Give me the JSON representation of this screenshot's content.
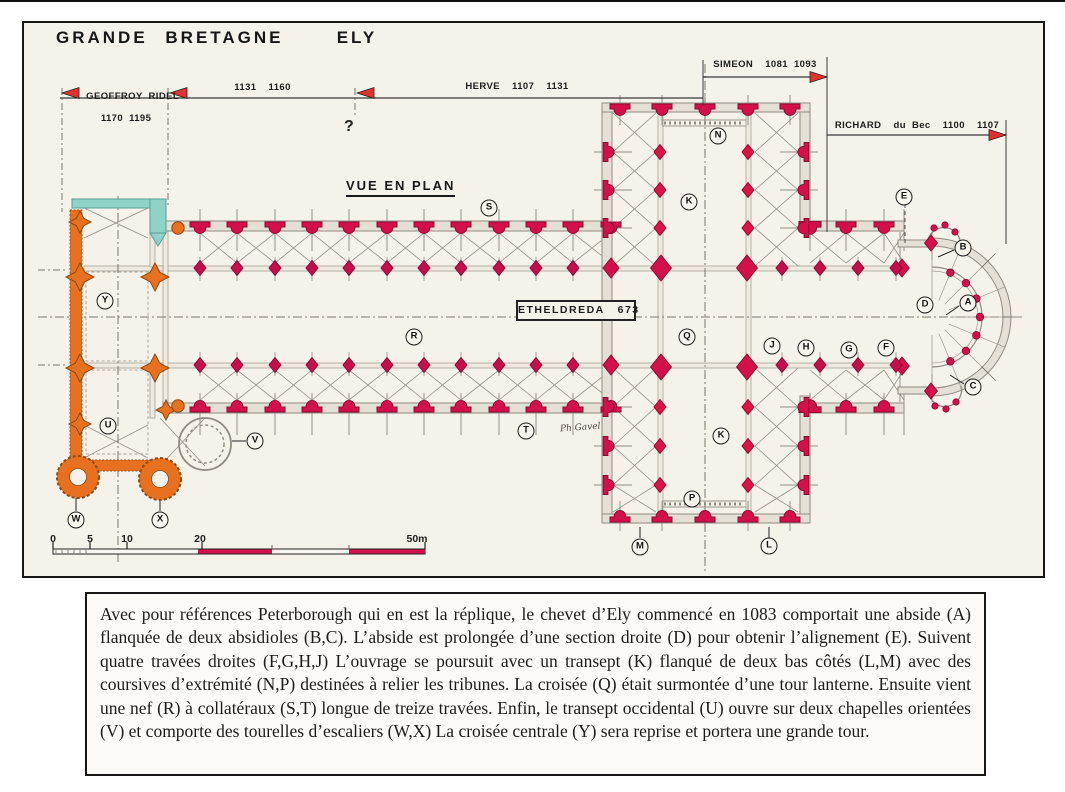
{
  "title": "GRANDE BRETAGNE   ELY",
  "timeline": {
    "segments": [
      {
        "label": "GEOFFROY RIDEL",
        "sublabel": "1170 1195"
      },
      {
        "label": "1131  1160"
      },
      {
        "label": "HERVE  1107  1131"
      },
      {
        "label": "SIMEON  1081 1093"
      },
      {
        "label": "RICHARD  du Bec  1100  1107"
      }
    ],
    "question_mark": "?"
  },
  "plan": {
    "view_label": "VUE EN PLAN",
    "founder_label": "ETHELDREDA   673",
    "signature": "Ph Gavel",
    "markers": [
      {
        "letter": "A",
        "x": 968,
        "y": 303
      },
      {
        "letter": "B",
        "x": 963,
        "y": 248
      },
      {
        "letter": "C",
        "x": 973,
        "y": 387
      },
      {
        "letter": "D",
        "x": 925,
        "y": 305
      },
      {
        "letter": "E",
        "x": 904,
        "y": 197
      },
      {
        "letter": "F",
        "x": 886,
        "y": 348
      },
      {
        "letter": "G",
        "x": 849,
        "y": 350
      },
      {
        "letter": "H",
        "x": 806,
        "y": 348
      },
      {
        "letter": "J",
        "x": 772,
        "y": 346
      },
      {
        "letter": "K",
        "x": 689,
        "y": 202
      },
      {
        "letter": "K",
        "x": 721,
        "y": 436
      },
      {
        "letter": "L",
        "x": 769,
        "y": 546
      },
      {
        "letter": "M",
        "x": 640,
        "y": 547
      },
      {
        "letter": "N",
        "x": 718,
        "y": 136
      },
      {
        "letter": "P",
        "x": 692,
        "y": 499
      },
      {
        "letter": "Q",
        "x": 687,
        "y": 337
      },
      {
        "letter": "R",
        "x": 414,
        "y": 337
      },
      {
        "letter": "S",
        "x": 489,
        "y": 208
      },
      {
        "letter": "T",
        "x": 526,
        "y": 431
      },
      {
        "letter": "U",
        "x": 108,
        "y": 426
      },
      {
        "letter": "V",
        "x": 255,
        "y": 441
      },
      {
        "letter": "W",
        "x": 76,
        "y": 520
      },
      {
        "letter": "X",
        "x": 160,
        "y": 520
      },
      {
        "letter": "Y",
        "x": 105,
        "y": 301
      }
    ],
    "scale": {
      "labels": [
        "0",
        "5",
        "10",
        "20",
        "50m"
      ]
    }
  },
  "colors": {
    "pillar_red": "#d4104a",
    "phase_orange": "#e8711f",
    "phase_teal": "#8fd2c8"
  },
  "caption": "Avec pour références Peterborough qui en est la réplique, le chevet d’Ely commencé en 1083 comportait une abside (A) flanquée de deux absidioles (B,C). L’abside est prolongée d’une section droite (D) pour obtenir l’alignement (E). Suivent quatre travées droites (F,G,H,J) L’ouvrage se poursuit avec un transept (K) flanqué de deux bas côtés (L,M) avec des coursives d’extrémité (N,P) destinées à relier les tribunes. La croisée (Q) était surmontée d’une tour lanterne. Ensuite vient une nef (R) à collatéraux (S,T) longue de treize travées. Enfin, le transept occidental (U) ouvre sur deux chapelles orientées (V) et comporte des tourelles d’escaliers (W,X) La croisée centrale (Y) sera reprise et portera une grande tour."
}
